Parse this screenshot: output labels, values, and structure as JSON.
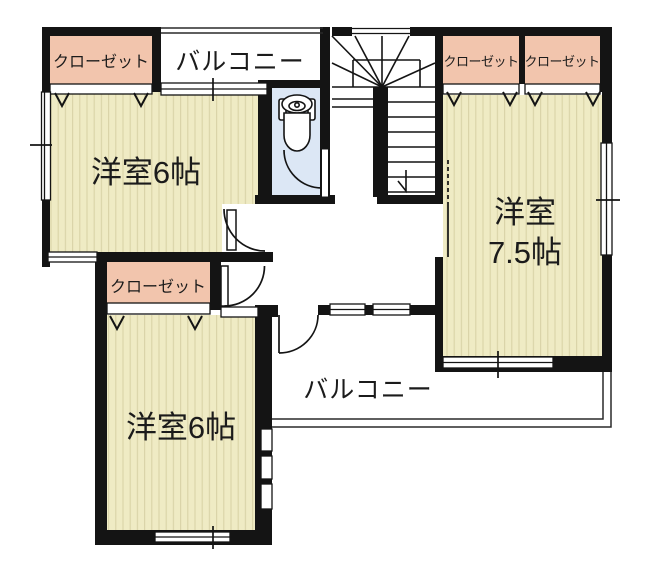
{
  "plan": {
    "type": "floor-plan",
    "floor_style": "japanese-residential"
  },
  "colors": {
    "wall": "#141414",
    "closet_fill": "#f2c5ad",
    "room_floor": "#efebc4",
    "room_stripe": "#d9d3a7",
    "toilet_fill": "#dce7f5",
    "background": "#ffffff"
  },
  "labels": {
    "closet_top_left": "クローゼット",
    "closet_top_right_1": "クローゼット",
    "closet_top_right_2": "クローゼット",
    "closet_middle": "クローゼット",
    "balcony_top": "バルコニー",
    "balcony_bottom": "バルコニー",
    "room_top_left": "洋室6帖",
    "room_right_line1": "洋室",
    "room_right_line2": "7.5帖",
    "room_bottom_left": "洋室6帖"
  },
  "rooms": [
    {
      "id": "western-room-1",
      "label": "洋室6帖",
      "size_jo": 6
    },
    {
      "id": "western-room-2",
      "label": "洋室7.5帖",
      "size_jo": 7.5
    },
    {
      "id": "western-room-3",
      "label": "洋室6帖",
      "size_jo": 6
    }
  ],
  "icons": [
    "toilet-icon",
    "staircase",
    "door-swing-arc",
    "closet-door-v-mark",
    "window-double-line"
  ]
}
